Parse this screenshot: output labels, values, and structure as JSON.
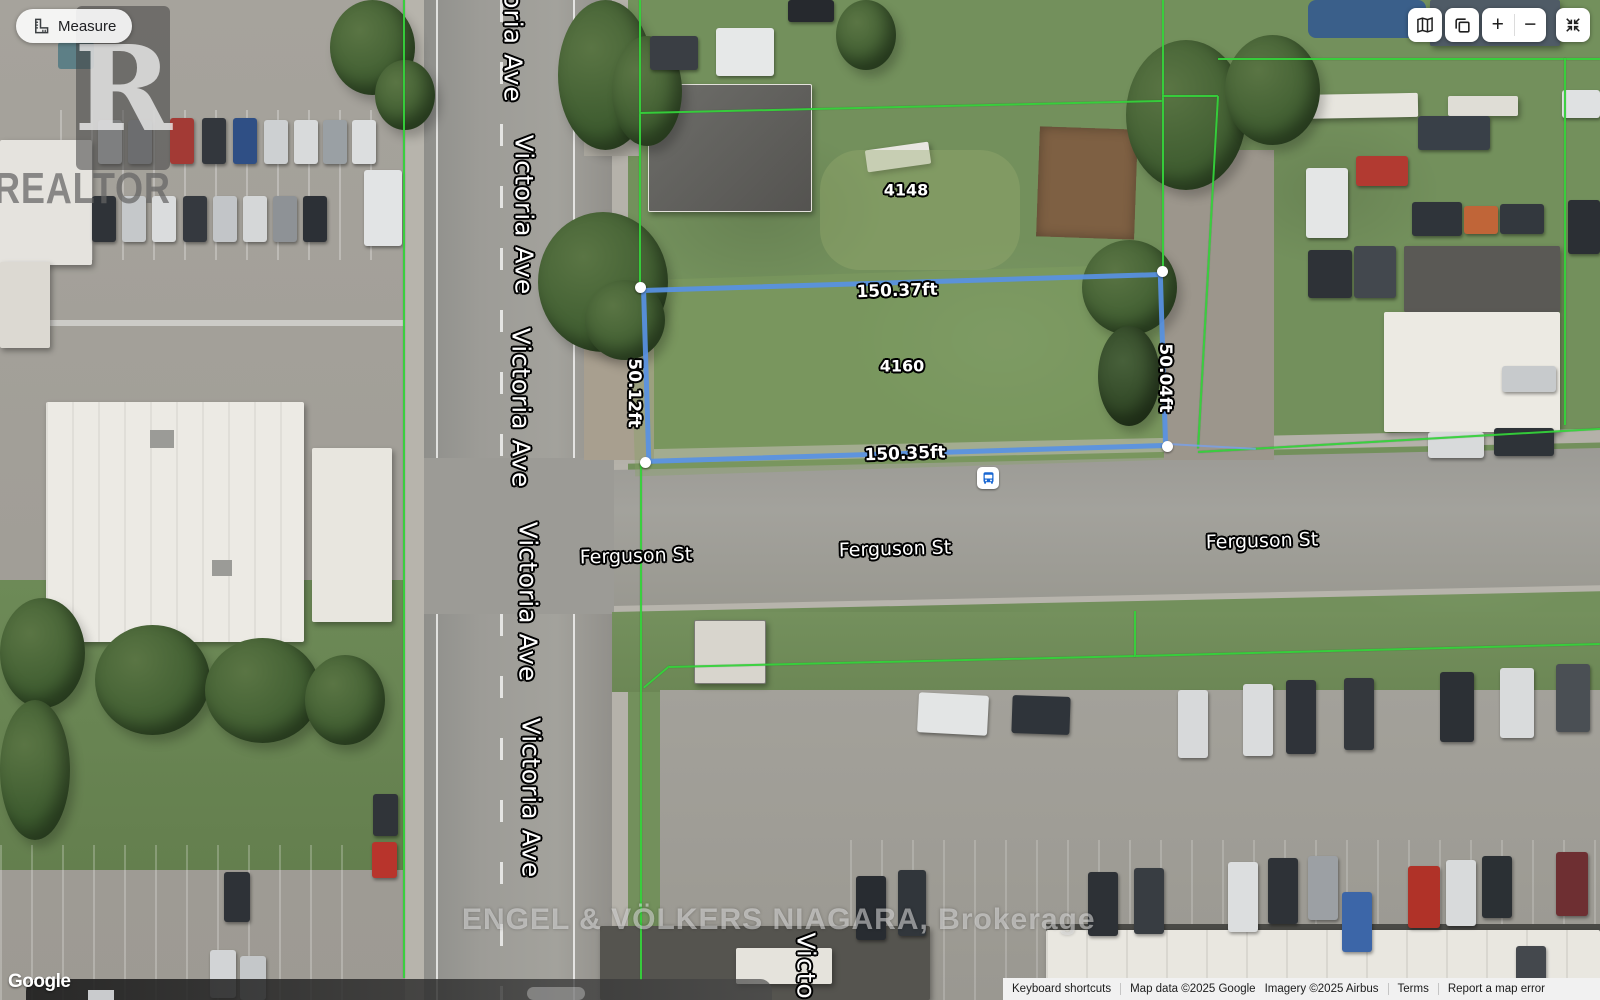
{
  "measure_tool": {
    "label": "Measure"
  },
  "map_controls": {
    "zoom_in_label": "+",
    "zoom_out_label": "−"
  },
  "measurement_overlay": {
    "top": "150.37ft",
    "bottom": "150.35ft",
    "left": "50.12ft",
    "right": "50.04ft",
    "line_color": "#5a92e3",
    "boundary_color": "#35d23b"
  },
  "address_labels": {
    "north_parcel": "4148",
    "subject_lot": "4160"
  },
  "street_labels": {
    "victoria": [
      "oria Ave",
      "Victoria Ave",
      "Victoria Ave",
      "Victoria Ave",
      "Victoria Ave",
      "Victo"
    ],
    "ferguson": [
      "Ferguson St",
      "Ferguson St",
      "Ferguson St"
    ]
  },
  "watermarks": {
    "realtor_initial": "R",
    "realtor": "REALTOR",
    "brokerage": "ENGEL & VÖLKERS NIAGARA, Brokerage"
  },
  "google_logo": "Google",
  "attribution": {
    "keyboard_shortcuts": "Keyboard shortcuts",
    "map_data": "Map data ©2025 Google",
    "imagery": "Imagery ©2025 Airbus",
    "terms": "Terms",
    "report_error": "Report a map error"
  }
}
